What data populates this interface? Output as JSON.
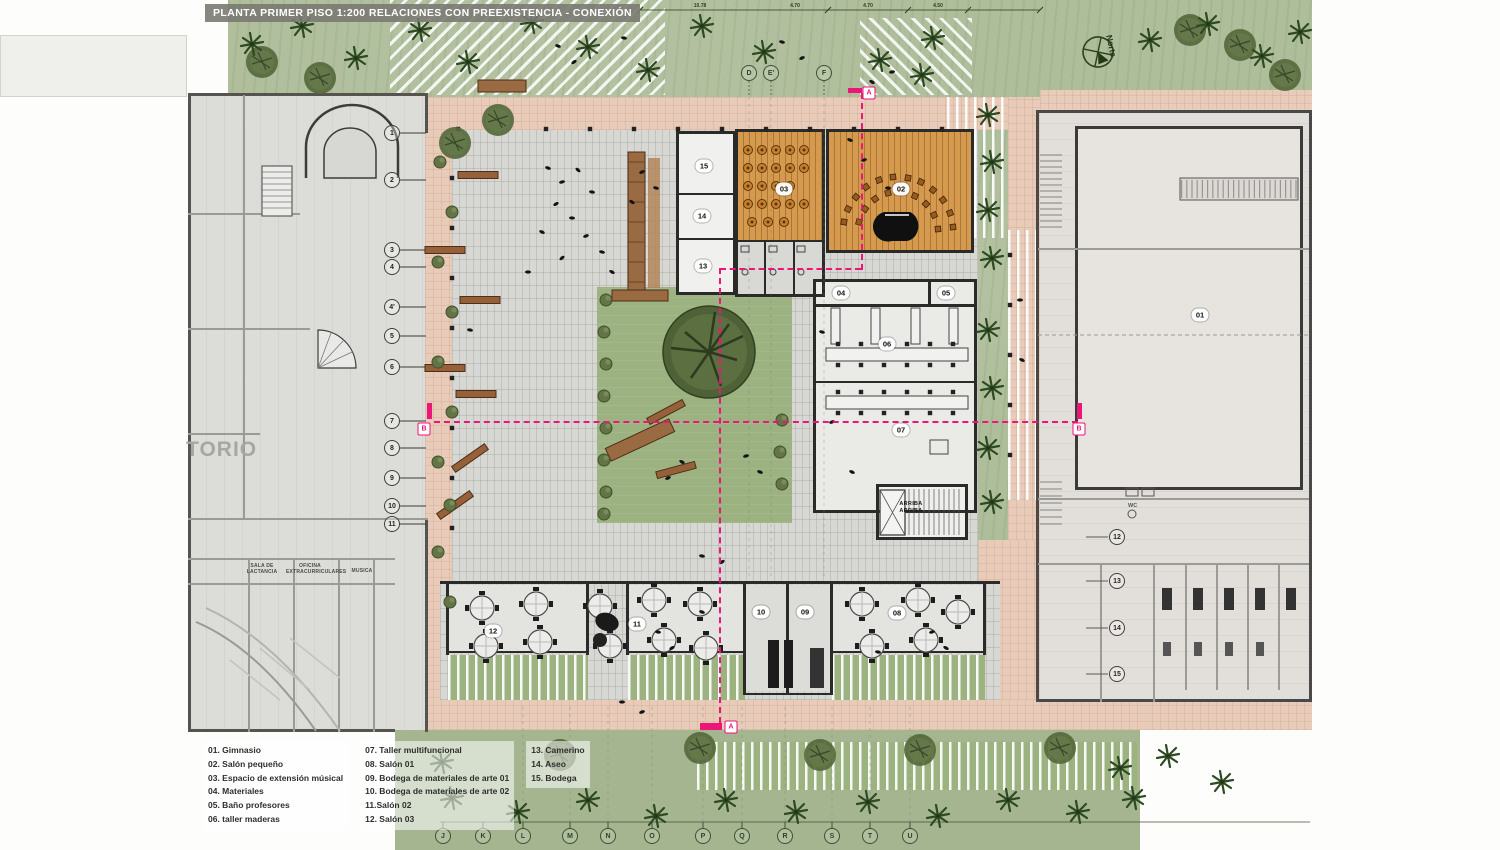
{
  "title": "PLANTA PRIMER PISO 1:200 RELACIONES CON PREEXISTENCIA  - CONEXIÓN",
  "compass": {
    "label": "Norte"
  },
  "auditorium_text": "TORIO",
  "stairs": {
    "line1": "ARRIBA",
    "line2": "ARRIBA"
  },
  "wc_label": "WC",
  "section_labels": {
    "a_top": "A",
    "a_bottom": "A",
    "b_left": "B",
    "b_right": "B"
  },
  "colors": {
    "accent_pink": "#ec1578",
    "wood": "#d59a4e",
    "grass": "#aebd9a",
    "paving_pink": "#e8cbb8",
    "plaza": "#d7d7d3",
    "dark_green": "#2e4a22"
  },
  "dimension_labels": [
    {
      "text": "10.78",
      "x": 700
    },
    {
      "text": "4.70",
      "x": 795
    },
    {
      "text": "4.70",
      "x": 868
    },
    {
      "text": "4.50",
      "x": 938
    }
  ],
  "grid_bubbles": {
    "left": [
      {
        "label": "1",
        "x": 392,
        "y": 133
      },
      {
        "label": "2",
        "x": 392,
        "y": 180
      },
      {
        "label": "3",
        "x": 392,
        "y": 250
      },
      {
        "label": "4",
        "x": 392,
        "y": 267
      },
      {
        "label": "4'",
        "x": 392,
        "y": 307
      },
      {
        "label": "5",
        "x": 392,
        "y": 336
      },
      {
        "label": "6",
        "x": 392,
        "y": 367
      },
      {
        "label": "7",
        "x": 392,
        "y": 421
      },
      {
        "label": "8",
        "x": 392,
        "y": 448
      },
      {
        "label": "9",
        "x": 392,
        "y": 478
      },
      {
        "label": "10",
        "x": 392,
        "y": 506
      },
      {
        "label": "11",
        "x": 392,
        "y": 524
      }
    ],
    "top": [
      {
        "label": "D",
        "x": 749,
        "y": 73
      },
      {
        "label": "E'",
        "x": 771,
        "y": 73
      },
      {
        "label": "F",
        "x": 824,
        "y": 73
      }
    ],
    "bottom": [
      {
        "label": "J",
        "x": 443,
        "y": 836
      },
      {
        "label": "K",
        "x": 483,
        "y": 836
      },
      {
        "label": "L",
        "x": 523,
        "y": 836
      },
      {
        "label": "M",
        "x": 570,
        "y": 836
      },
      {
        "label": "N",
        "x": 608,
        "y": 836
      },
      {
        "label": "O",
        "x": 652,
        "y": 836
      },
      {
        "label": "P",
        "x": 703,
        "y": 836
      },
      {
        "label": "Q",
        "x": 742,
        "y": 836
      },
      {
        "label": "R",
        "x": 785,
        "y": 836
      },
      {
        "label": "S",
        "x": 832,
        "y": 836
      },
      {
        "label": "T",
        "x": 870,
        "y": 836
      },
      {
        "label": "U",
        "x": 910,
        "y": 836
      }
    ],
    "right": [
      {
        "label": "12",
        "x": 1117,
        "y": 537
      },
      {
        "label": "13",
        "x": 1117,
        "y": 581
      },
      {
        "label": "14",
        "x": 1117,
        "y": 628
      },
      {
        "label": "15",
        "x": 1117,
        "y": 674
      }
    ]
  },
  "room_tags": [
    {
      "label": "01",
      "x": 1200,
      "y": 315
    },
    {
      "label": "02",
      "x": 901,
      "y": 189
    },
    {
      "label": "03",
      "x": 784,
      "y": 189
    },
    {
      "label": "04",
      "x": 841,
      "y": 293
    },
    {
      "label": "05",
      "x": 946,
      "y": 293
    },
    {
      "label": "06",
      "x": 887,
      "y": 344
    },
    {
      "label": "07",
      "x": 901,
      "y": 430
    },
    {
      "label": "08",
      "x": 897,
      "y": 613
    },
    {
      "label": "09",
      "x": 805,
      "y": 612
    },
    {
      "label": "10",
      "x": 761,
      "y": 612
    },
    {
      "label": "11",
      "x": 637,
      "y": 624
    },
    {
      "label": "12",
      "x": 493,
      "y": 631
    },
    {
      "label": "13",
      "x": 703,
      "y": 266
    },
    {
      "label": "14",
      "x": 702,
      "y": 216
    },
    {
      "label": "15",
      "x": 704,
      "y": 166
    }
  ],
  "annotations": [
    {
      "text": "SALA DE LACTANCIA",
      "x": 262,
      "y": 564
    },
    {
      "text": "OFICINA EXTRACURRICULARES",
      "x": 310,
      "y": 564
    },
    {
      "text": "MUSICA",
      "x": 362,
      "y": 569
    }
  ],
  "legend": {
    "col1": [
      "01. Gimnasio",
      "02. Salón pequeño",
      "03. Espacio de extensión músical",
      "04. Materiales",
      "05. Baño profesores",
      "06. taller maderas"
    ],
    "col2": [
      "07. Taller multifuncional",
      "08. Salón 01",
      "09. Bodega de materiales de arte 01",
      "10. Bodega de materiales de arte 02",
      "11.Salón 02",
      "12. Salón 03"
    ],
    "col3": [
      "13. Camerino",
      "14. Aseo",
      "15. Bodega"
    ]
  }
}
